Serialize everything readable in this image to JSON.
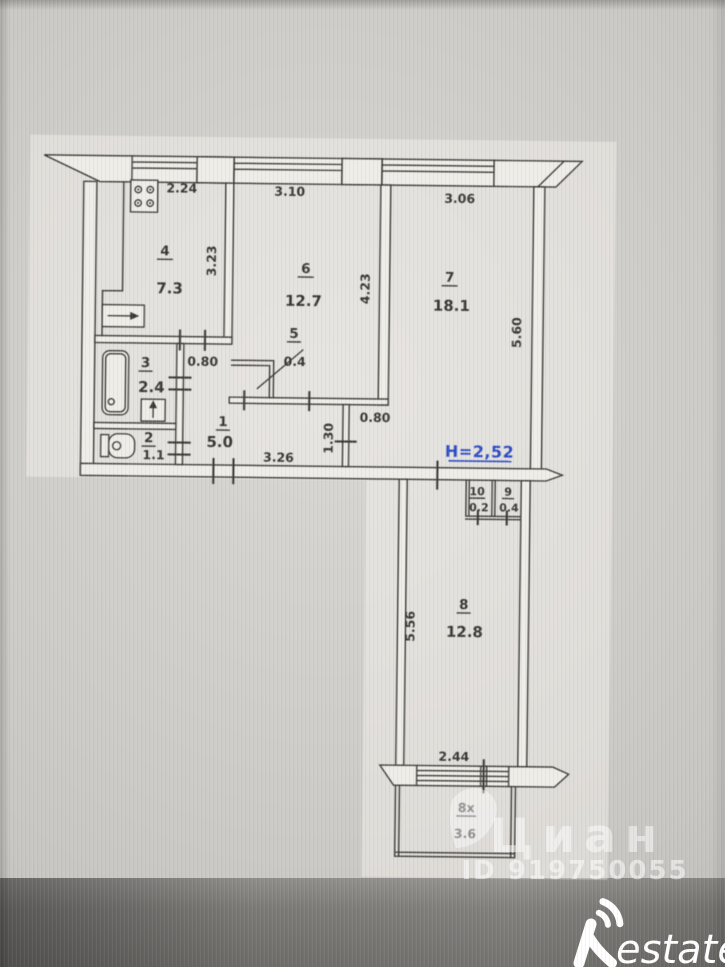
{
  "rooms": {
    "r1": {
      "number": "1",
      "area": "5.0"
    },
    "r2": {
      "number": "2",
      "area": "1.1"
    },
    "r3": {
      "number": "3",
      "area": "2.4"
    },
    "r4": {
      "number": "4",
      "area": "7.3"
    },
    "r5": {
      "number": "5",
      "area": "0.4"
    },
    "r6": {
      "number": "6",
      "area": "12.7"
    },
    "r7": {
      "number": "7",
      "area": "18.1"
    },
    "r8": {
      "number": "8",
      "area": "12.8"
    },
    "r9": {
      "number": "9",
      "area": "0.4"
    },
    "r10": {
      "number": "10",
      "area": "0.2"
    },
    "balcony": {
      "number": "8х",
      "area": "3.6"
    }
  },
  "dims": {
    "kitchen_window": "2.24",
    "room6_window": "3.10",
    "room7_window": "3.06",
    "kitchen_depth": "3.23",
    "room6_depth": "4.23",
    "room7_depth": "5.60",
    "kitchen_door": "0.80",
    "room7_opening": "0.80",
    "hall_length": "3.26",
    "hall_jog": "1.30",
    "room8_depth": "5.56",
    "balcony_width": "2.44"
  },
  "annotations": {
    "ceiling_height": "Н=2,52"
  },
  "watermarks": {
    "brand": "Циан",
    "listing_id": "ID 919750055",
    "agency": {
      "initial": "R",
      "rest": "estate"
    }
  },
  "colors": {
    "line": "#3b3834",
    "height_note": "#2e4cc3",
    "watermark": "#ffffff"
  }
}
